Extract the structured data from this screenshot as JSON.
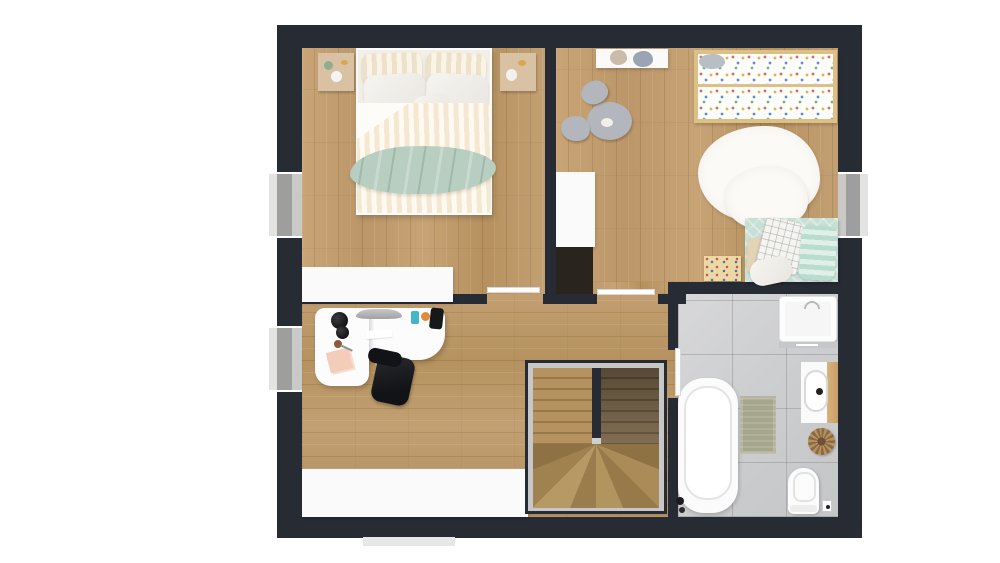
{
  "app": {
    "title": "3D floor plan render — upper floor, top-down view"
  },
  "palette": {
    "wall": "#272b33",
    "furn-white": "#fafafa",
    "beige": "#d9c2a4",
    "sage": "#b7cec1",
    "duvet": "#f5e8d3",
    "mint": "#c8dfd5",
    "crib": "#debf85",
    "gray-furn": "#b3b7bd",
    "dark-cab": "#2a241f",
    "mat": "#a6a58d",
    "pink": "#f3cdba"
  },
  "rooms": [
    {
      "id": "bedroom",
      "label": "Bedroom",
      "furniture": [
        "double-bed",
        "striped-pillows",
        "white-pillows",
        "striped-duvet",
        "sage-throw-blanket",
        "nightstand-left",
        "nightstand-right",
        "white-wardrobe"
      ]
    },
    {
      "id": "kids-room",
      "label": "Kids room",
      "furniture": [
        "wall-shelf-with-teddy-bears",
        "crib-with-confetti-bedding",
        "gray-play-table",
        "two-gray-poufs",
        "sheepskin-rug",
        "daybed-with-pillows",
        "toy-organizer-box",
        "white-wardrobe",
        "dark-cabinet"
      ]
    },
    {
      "id": "office",
      "label": "Office",
      "furniture": [
        "l-shaped-white-desk",
        "monitor",
        "desk-lamp",
        "black-office-chair",
        "white-sideboard"
      ]
    },
    {
      "id": "hallway",
      "label": "Hallway",
      "furniture": []
    },
    {
      "id": "staircase",
      "label": "Staircase",
      "furniture": [
        "u-shaped-winder-stairs"
      ]
    },
    {
      "id": "bathroom",
      "label": "Bathroom",
      "furniture": [
        "shower-cabin",
        "vanity-sink",
        "laundry-basket",
        "bathtub",
        "bath-mat",
        "toilet",
        "toilet-paper-holder"
      ]
    }
  ],
  "openings": {
    "windows": [
      {
        "wall": "left",
        "room": "bedroom"
      },
      {
        "wall": "left",
        "room": "office"
      },
      {
        "wall": "right",
        "room": "kids-room"
      }
    ],
    "doors": [
      {
        "room": "bedroom",
        "state": "open"
      },
      {
        "room": "kids-room",
        "state": "open"
      },
      {
        "room": "bathroom",
        "state": "open"
      }
    ]
  }
}
